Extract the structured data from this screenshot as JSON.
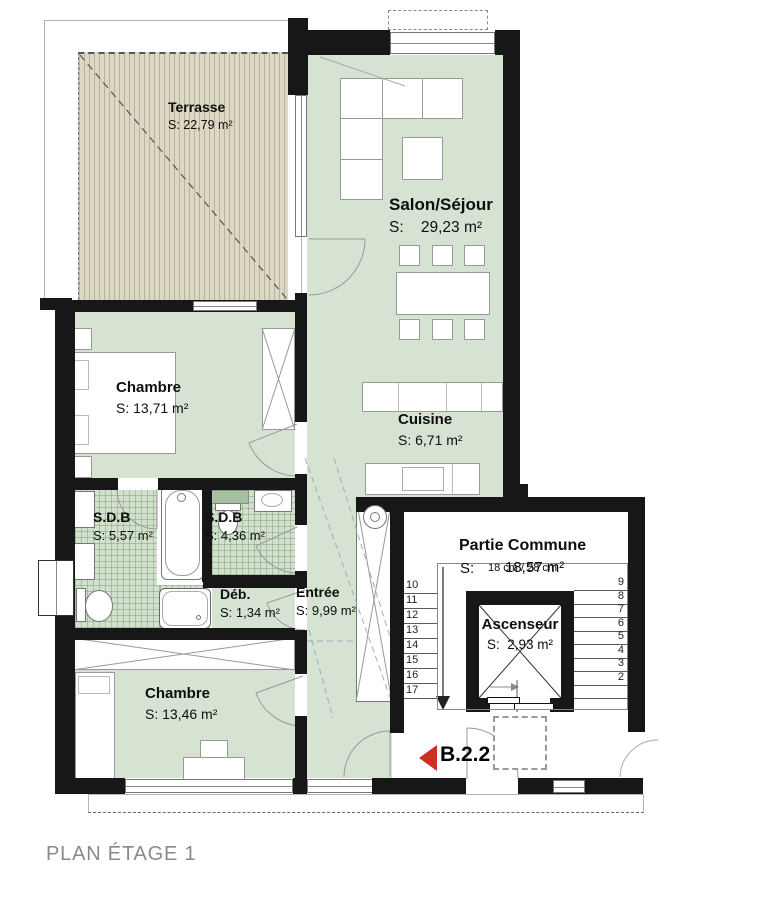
{
  "plan": {
    "caption": "PLAN ÉTAGE 1",
    "unit_label": "B.2.2",
    "rooms": {
      "terrasse": {
        "name": "Terrasse",
        "area": "S: 22,79 m²"
      },
      "salon": {
        "name": "Salon/Séjour",
        "area": "S:    29,23 m²"
      },
      "cuisine": {
        "name": "Cuisine",
        "area": "S: 6,71 m²"
      },
      "chambre1": {
        "name": "Chambre",
        "area": "S: 13,71 m²"
      },
      "sdb1": {
        "name": "S.D.B",
        "area": "S: 5,57 m²"
      },
      "sdb2": {
        "name": "S.D.B",
        "area": "S: 4,36 m²"
      },
      "debarras": {
        "name": "Déb.",
        "area": "S: 1,34 m²"
      },
      "entree": {
        "name": "Entrée",
        "area": "S: 9,99 m²"
      },
      "chambre2": {
        "name": "Chambre",
        "area": "S: 13,46 m²"
      },
      "partie_commune": {
        "name": "Partie Commune",
        "area_prefix": "S:",
        "area_value": "18,57 m²",
        "step_note": "18 cm / 28 cm"
      },
      "ascenseur": {
        "name": "Ascenseur",
        "area": "S:  2,93 m²"
      }
    },
    "stairs": {
      "left_numbers": [
        "10",
        "11",
        "12",
        "13",
        "14",
        "15",
        "16",
        "17"
      ],
      "right_numbers": [
        "9",
        "8",
        "7",
        "6",
        "5",
        "4",
        "3",
        "2"
      ]
    },
    "colors": {
      "floor_green": "#d6e3d3",
      "tile_green": "#d2e0cd",
      "terrace_beige": "#dcd8c3",
      "wall_black": "#171717",
      "marker_red": "#d02f23",
      "caption_gray": "#8a8a8a"
    }
  }
}
